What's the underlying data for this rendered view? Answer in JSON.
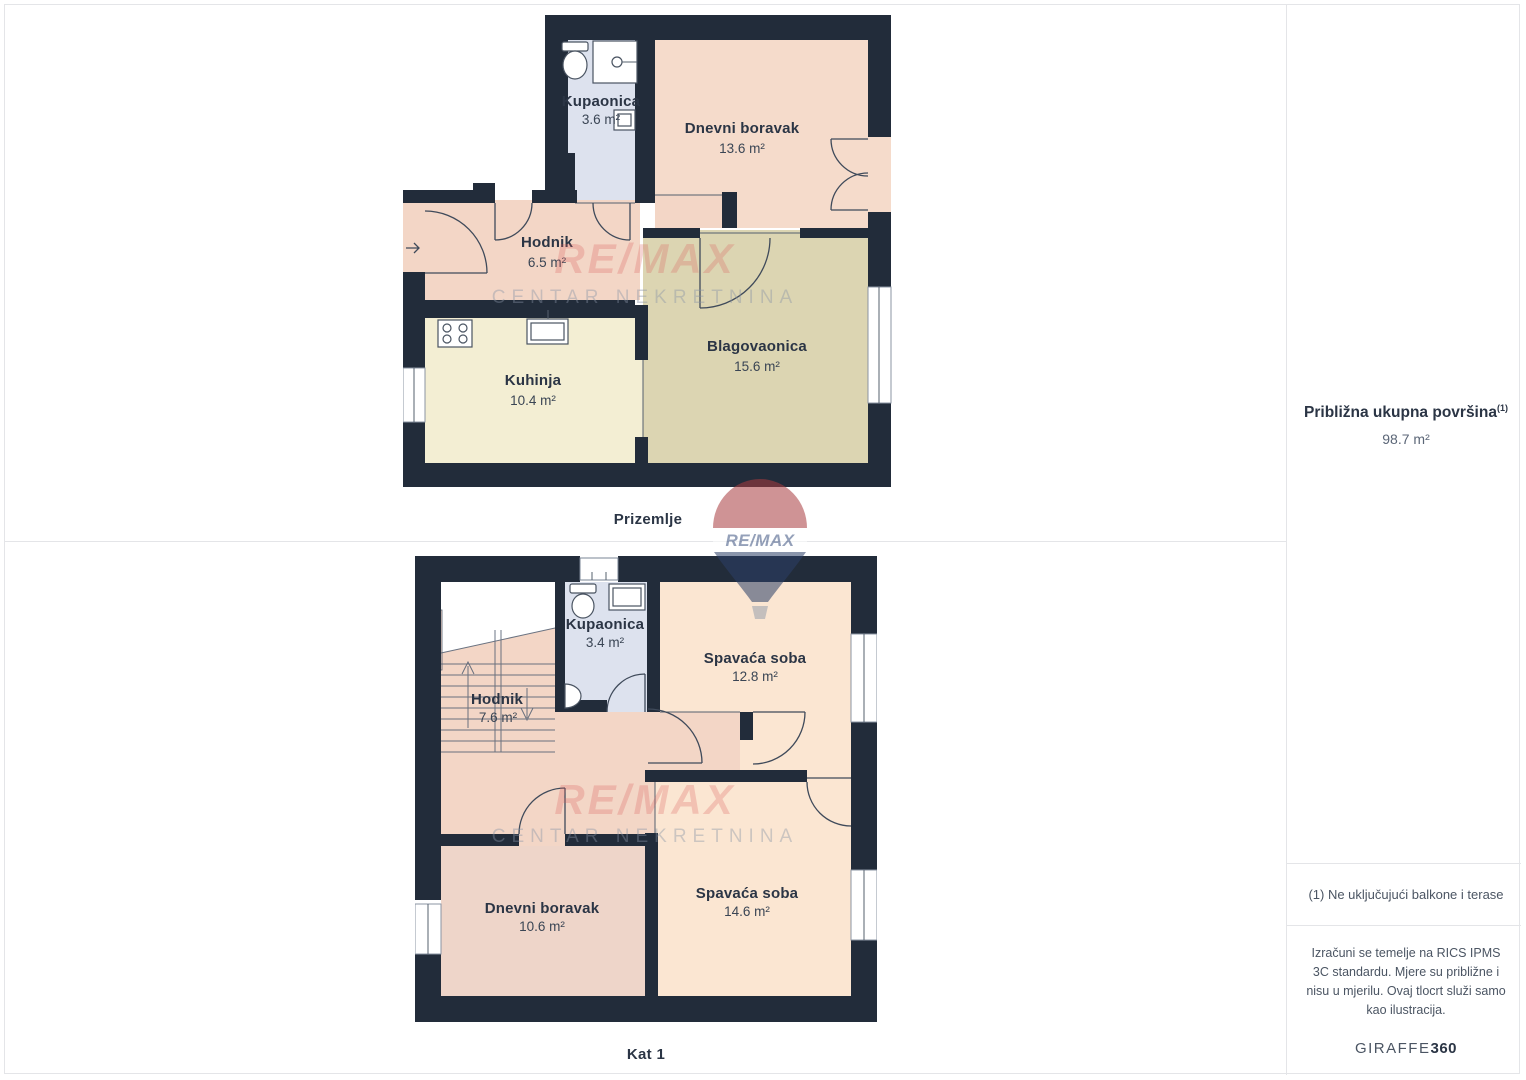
{
  "colors": {
    "wall": "#222c3a",
    "room_pink": "#f5dbcb",
    "room_salmon": "#f3d6c6",
    "room_blue": "#dde2ee",
    "room_cream": "#f3eed3",
    "room_tan": "#dcd5b2",
    "room_peach": "#fbe6d2",
    "room_dusty": "#eed5c9",
    "label": "#2b3545",
    "muted": "#5b6677",
    "muted2": "#4b5563",
    "line": "#e4e5e8",
    "watermark_red": "#d95b5b",
    "balloon_red": "#a93c3f",
    "balloon_blue": "#2c3f68"
  },
  "watermark": {
    "brand": "RE/MAX",
    "subtitle": "CENTAR NEKRETNINA"
  },
  "floors": {
    "ground": {
      "label": "Prizemlje",
      "rooms": {
        "kupaonica": {
          "name": "Kupaonica",
          "area": "3.6 m²"
        },
        "dnevni": {
          "name": "Dnevni boravak",
          "area": "13.6 m²"
        },
        "hodnik": {
          "name": "Hodnik",
          "area": "6.5 m²"
        },
        "kuhinja": {
          "name": "Kuhinja",
          "area": "10.4 m²"
        },
        "blagovaonica": {
          "name": "Blagovaonica",
          "area": "15.6 m²"
        }
      }
    },
    "first": {
      "label": "Kat 1",
      "rooms": {
        "kupaonica": {
          "name": "Kupaonica",
          "area": "3.4 m²"
        },
        "spavaca1": {
          "name": "Spavaća soba",
          "area": "12.8 m²"
        },
        "hodnik": {
          "name": "Hodnik",
          "area": "7.6 m²"
        },
        "dnevni": {
          "name": "Dnevni boravak",
          "area": "10.6 m²"
        },
        "spavaca2": {
          "name": "Spavaća soba",
          "area": "14.6 m²"
        }
      }
    }
  },
  "sidebar": {
    "total_area_label": "Približna ukupna površina",
    "total_area_sup": "(1)",
    "total_area_value": "98.7 m²",
    "footnote": "(1) Ne uključujući balkone i terase",
    "disclaimer": "Izračuni se temelje na RICS IPMS 3C standardu. Mjere su približne i nisu u mjerilu. Ovaj tlocrt služi samo kao ilustracija.",
    "brand_normal": "GIRAFFE",
    "brand_bold": "360"
  }
}
